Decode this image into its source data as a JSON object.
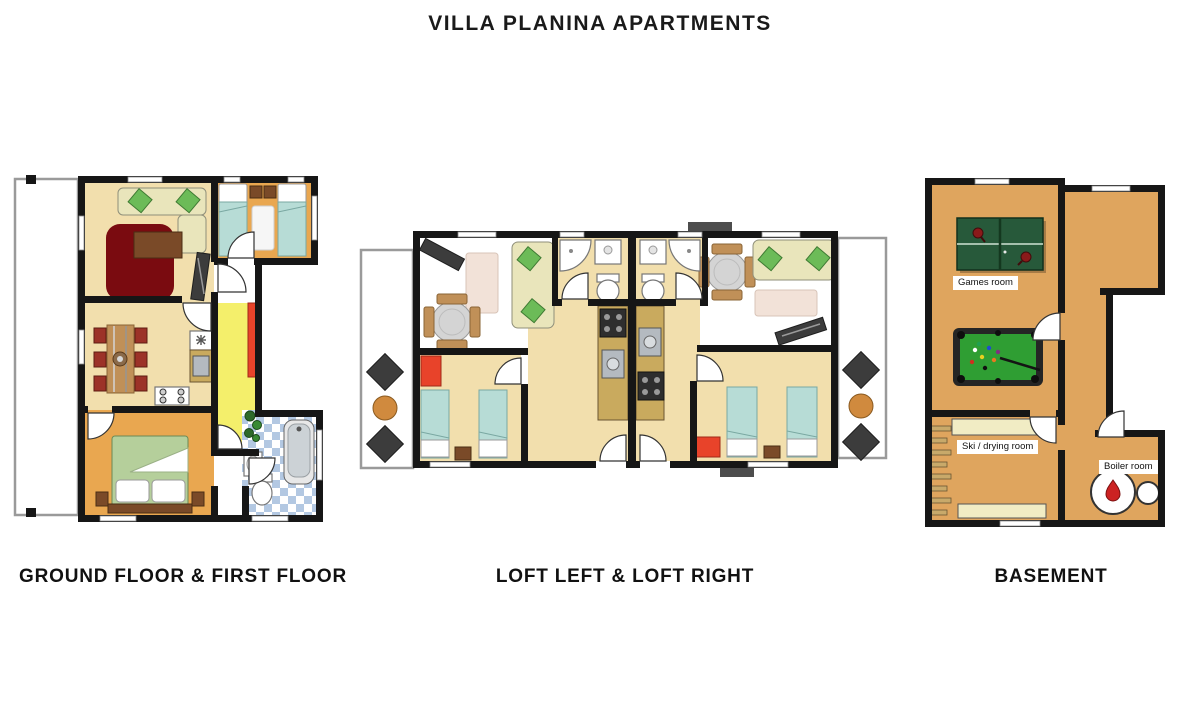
{
  "header": {
    "title": "VILLA PLANINA APARTMENTS"
  },
  "plans": [
    {
      "id": "ground-first",
      "caption": "GROUND FLOOR & FIRST FLOOR"
    },
    {
      "id": "loft",
      "caption": "LOFT LEFT & LOFT RIGHT"
    },
    {
      "id": "basement",
      "caption": "BASEMENT",
      "labels": {
        "games": "Games room",
        "ski": "Ski / drying room",
        "boiler": "Boiler room"
      }
    }
  ],
  "icons": [
    "sofa-icon",
    "coffee-table-icon",
    "rug-icon",
    "dining-table-icon",
    "chair-icon",
    "stove-icon",
    "washer-icon",
    "sink-icon",
    "bed-icon",
    "double-bed-icon",
    "nightstand-icon",
    "bathtub-icon",
    "toilet-icon",
    "shower-icon",
    "plant-icon",
    "wardrobe-icon",
    "stool-icon",
    "armchair-icon",
    "balcony-table-icon",
    "tv-shelf-icon",
    "ping-pong-table-icon",
    "pool-table-icon",
    "bench-icon",
    "ski-rack-icon",
    "boiler-icon",
    "door-icon",
    "window-icon"
  ],
  "colors": {
    "wall": "#161616",
    "floor_cream": "#f2dfad",
    "floor_orange": "#e9a750",
    "floor_ochre": "#dfa55e",
    "floor_yellow": "#f4ef6b",
    "accent_red": "#e8432a",
    "rug_maroon": "#7a0b10",
    "bed_teal": "#b7dcd6",
    "bed_green": "#b5cf9b",
    "sofa_cream": "#e9e5bb",
    "cushion_green": "#6cbb58",
    "wood": "#c09058",
    "wood_dark": "#7a4a28",
    "counter_wood": "#c9aa5e",
    "pingpong_green": "#27593a",
    "pool_green": "#2f9e33",
    "rug_pink": "#f2e2d8",
    "tile_blue": "#b3c8e2",
    "balcony_gray": "#9a9a9a",
    "chair_red": "#9c3228",
    "dark_furn": "#3c3c3c",
    "bench": "#f1ecc4"
  }
}
